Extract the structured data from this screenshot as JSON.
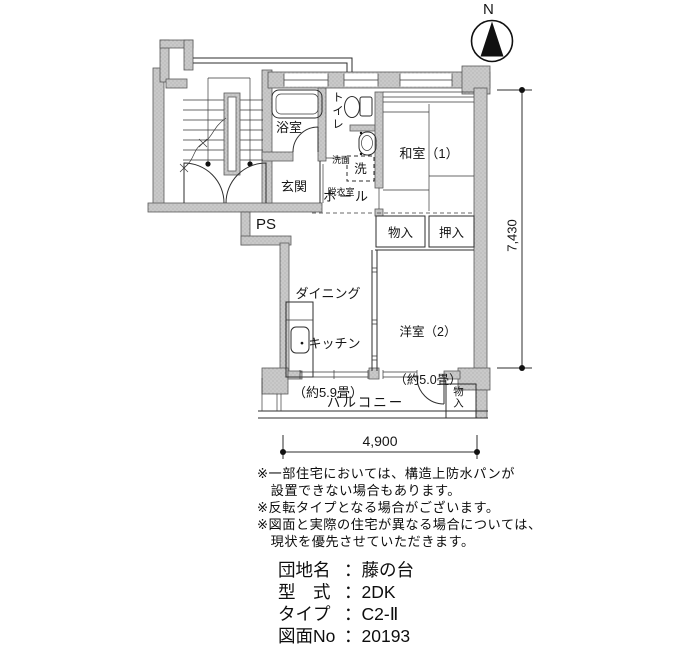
{
  "compass": {
    "label": "N"
  },
  "plan": {
    "rooms": {
      "bath": "浴室",
      "toilet": "トイレ",
      "washroom_line1": "洗面",
      "washroom_line2": "脱衣室",
      "washer": "洗",
      "japanese_room": "和室（1）",
      "entrance": "玄関",
      "hall": "ホール",
      "pipe_space": "PS",
      "storage1": "物入",
      "closet": "押入",
      "dk_line1": "ダイニング",
      "dk_line2": "・キッチン",
      "dk_line3": "（約5.9畳）",
      "western_room_line1": "洋室（2）",
      "western_room_line2": "（約5.0畳）",
      "balcony": "バルコニー",
      "balcony_storage": "物入"
    },
    "dimensions": {
      "height": "7,430",
      "width": "4,900"
    }
  },
  "notes": {
    "lines": [
      "※一部住宅においては、構造上防水パンが",
      "　設置できない場合もあります。",
      "※反転タイプとなる場合がございます。",
      "※図面と実際の住宅が異なる場合については、",
      "　現状を優先させていただきます。"
    ]
  },
  "property": {
    "separator": "：",
    "items": [
      {
        "label": "団地名",
        "value": "藤の台"
      },
      {
        "label": "型　式",
        "value": "2DK"
      },
      {
        "label": "タイプ",
        "value": "C2-Ⅱ"
      },
      {
        "label": "図面No",
        "value": "20193"
      }
    ]
  },
  "colors": {
    "wall_fill": "#c9c9c9",
    "line": "#2e2e2e",
    "text": "#111111"
  }
}
